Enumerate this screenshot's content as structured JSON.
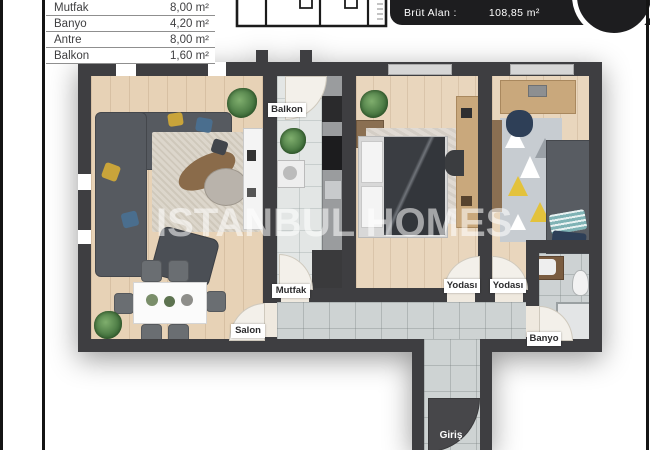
{
  "area_table": {
    "rows": [
      {
        "label": "Mutfak",
        "value": "8,00 m²"
      },
      {
        "label": "Banyo",
        "value": "4,20 m²"
      },
      {
        "label": "Antre",
        "value": "8,00 m²"
      },
      {
        "label": "Balkon",
        "value": "1,60 m²"
      }
    ]
  },
  "header": {
    "label": "Brüt Alan :",
    "value": "108,85 m²"
  },
  "watermark": "ISTANBUL HOMES",
  "rooms": {
    "balkon": "Balkon",
    "mutfak": "Mutfak",
    "salon": "Salon",
    "bedroom1": "Yodası",
    "bedroom2": "Yodası",
    "banyo": "Banyo",
    "giris": "Giriş"
  },
  "colors": {
    "wall": "#3e3e41",
    "wood_floor": "#e7d2b6",
    "kitchen_tile": "#e3e6e5",
    "hall_tile": "#ced3d3",
    "header_bg": "#1d1d1f",
    "desk_wood": "#c9a87c",
    "label_bg": "#ffffff"
  }
}
